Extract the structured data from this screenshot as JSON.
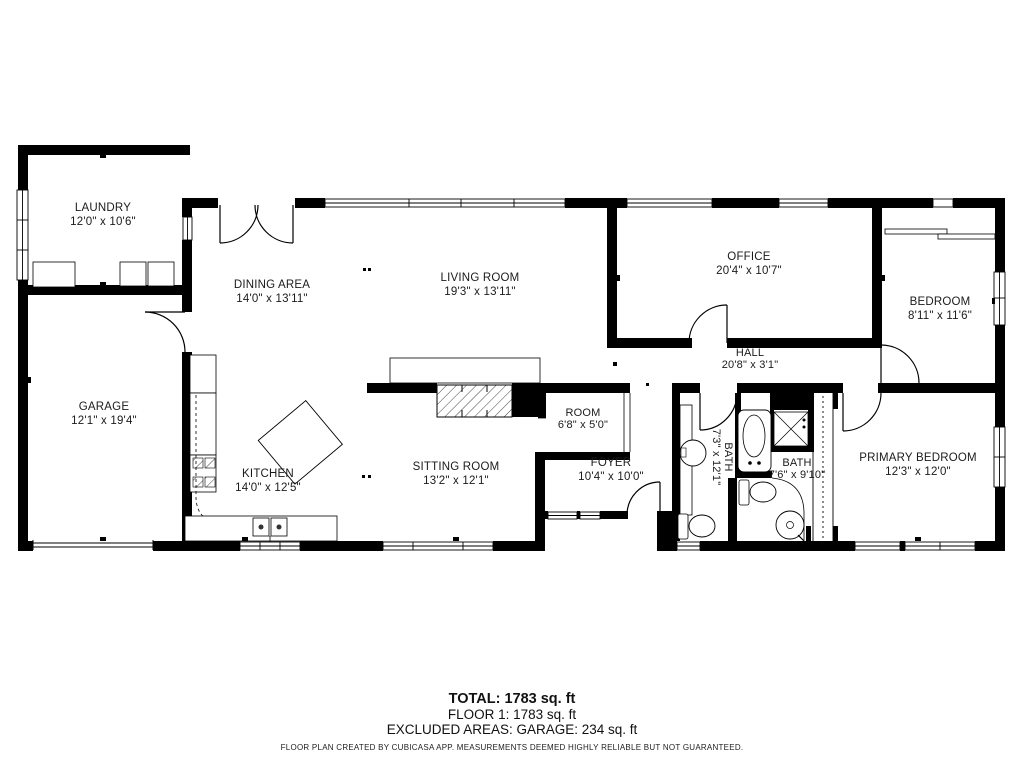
{
  "rooms": [
    {
      "name": "LAUNDRY",
      "dims": "12'0\" x 10'6\""
    },
    {
      "name": "DINING AREA",
      "dims": "14'0\" x 13'11\""
    },
    {
      "name": "LIVING ROOM",
      "dims": "19'3\" x 13'11\""
    },
    {
      "name": "OFFICE",
      "dims": "20'4\" x 10'7\""
    },
    {
      "name": "BEDROOM",
      "dims": "8'11\" x 11'6\""
    },
    {
      "name": "HALL",
      "dims": "20'8\" x 3'1\""
    },
    {
      "name": "GARAGE",
      "dims": "12'1\" x 19'4\""
    },
    {
      "name": "KITCHEN",
      "dims": "14'0\" x 12'5\""
    },
    {
      "name": "SITTING ROOM",
      "dims": "13'2\" x 12'1\""
    },
    {
      "name": "ROOM",
      "dims": "6'8\" x 5'0\""
    },
    {
      "name": "FOYER",
      "dims": "10'4\" x 10'0\""
    },
    {
      "name": "BATH",
      "dims": "7'3\" x 12'1\""
    },
    {
      "name": "BATH",
      "dims": "7'6\" x 9'10\""
    },
    {
      "name": "PRIMARY BEDROOM",
      "dims": "12'3\" x 12'0\""
    }
  ],
  "summary": {
    "total": "TOTAL: 1783 sq. ft",
    "floor": "FLOOR 1: 1783 sq. ft",
    "excluded": "EXCLUDED AREAS: GARAGE: 234 sq. ft",
    "disclaimer": "FLOOR PLAN CREATED BY CUBICASA APP. MEASUREMENTS DEEMED HIGHLY RELIABLE BUT NOT GUARANTEED."
  },
  "colors": {
    "walls": "#000000",
    "background": "#ffffff",
    "text": "#1b1b1b"
  }
}
